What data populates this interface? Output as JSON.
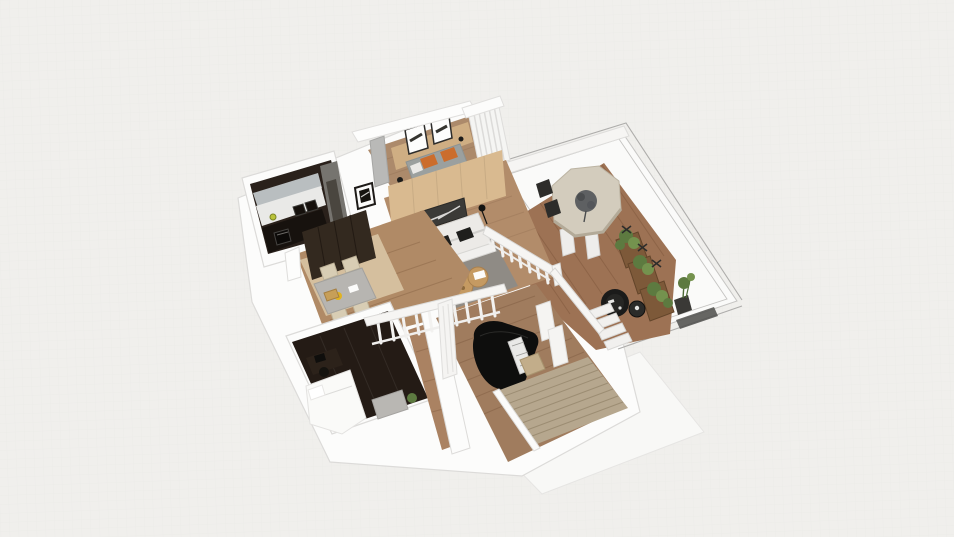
{
  "app": {
    "view_type": "3d-floorplan-render",
    "projection": "bird's-eye oblique perspective",
    "visible_text": "none"
  },
  "palette": {
    "bg": "#f0efec",
    "grid": "#e8e7e5",
    "slab": "#fcfcfb",
    "slab_shadow": "#f8f8f6",
    "wall_stroke": "#dcdbd9",
    "railing_white": "#f6f5f3",
    "wood_bedroom": "#ac8a6b",
    "wood_living": "#b28c6a",
    "wood_hall": "#b08a66",
    "wood_light": "#d5bf9e",
    "wood_deck": "#9d7254",
    "wood_piano": "#a07c5e",
    "wood_corridor": "#aa8262",
    "headboard": "#cfae83",
    "accent_wall": "#d9ba90",
    "art_dark": "#3b3a37",
    "bed_gray": "#9ba09f",
    "pillow_orange": "#cb6d2d",
    "rug": "#8f8b85",
    "sofa": "#eceae7",
    "pillow_black": "#1f1f1d",
    "rattan": "#c59a62",
    "kitchen_dark": "#2a211b",
    "kitchen_counter": "#e9e9e7",
    "kitchen_backsplash": "#b9bec0",
    "kitchen_cab_gray": "#76746f",
    "kitchen_lower": "#17120e",
    "nook_table": "#b7b5b1",
    "chair_beige": "#d8cdb4",
    "wardrobe": "#33291f",
    "darkroom_floor": "#241b15",
    "bed_white": "#fafaf8",
    "ottoman_gray": "#b9b7b3",
    "piano_black": "#0e0e0d",
    "piano_keys": "#e9e9e7",
    "bench": "#c2ad8a",
    "stairs": "#b6a78e",
    "deck_table": "#d3ccbd",
    "centerpiece": "#5e6062",
    "planter": "#7d5939",
    "plant_green": "#5d7a40",
    "plant_light": "#74924e",
    "black_chair": "#1b1b1a",
    "side_table": "#2b2b29",
    "steps_white": "#f1f0ee",
    "yellow_item": "#e0b322"
  },
  "rooms": [
    {
      "id": "kitchen",
      "label": "Kitchen",
      "furniture": [
        "dark cabinetry",
        "white countertop",
        "gray backsplash",
        "cooktop",
        "oven",
        "tall gray cabinets",
        "wall picture"
      ]
    },
    {
      "id": "bedroom",
      "label": "Bedroom",
      "furniture": [
        "double bed with gray duvet",
        "orange pillows",
        "wood headboard wall",
        "two framed artworks",
        "gray wardrobe panel",
        "window curtains",
        "floor lamp"
      ]
    },
    {
      "id": "living-room",
      "label": "Living Room",
      "furniture": [
        "white sofa",
        "black cushions",
        "gray area rug",
        "rattan poufs",
        "wood accent wall with artwork",
        "floor lamp",
        "potted plant on stand"
      ]
    },
    {
      "id": "dining-nook",
      "label": "Dining Nook",
      "furniture": [
        "gray table",
        "beige chairs",
        "serving tray",
        "yellow plate",
        "dark wardrobe"
      ]
    },
    {
      "id": "second-bedroom",
      "label": "Bedroom 2 (dark floor)",
      "furniture": [
        "white bed",
        "desk",
        "desk chair",
        "gray ottoman",
        "potted plant"
      ]
    },
    {
      "id": "music-room",
      "label": "Music Room",
      "furniture": [
        "black grand piano",
        "piano bench",
        "white balustrade",
        "white curtain panels"
      ]
    },
    {
      "id": "staircase",
      "label": "Staircase",
      "furniture": [
        "beige steps",
        "white side wall",
        "handrail"
      ]
    },
    {
      "id": "terrace",
      "label": "Glass Terrace / Sunroom",
      "furniture": [
        "octagonal dining table",
        "dark centerpiece plant",
        "dark dining chairs",
        "wood planter boxes with greenery",
        "black papasan chair",
        "round side table",
        "tall potted plant",
        "white deck steps",
        "glass walls"
      ]
    }
  ]
}
